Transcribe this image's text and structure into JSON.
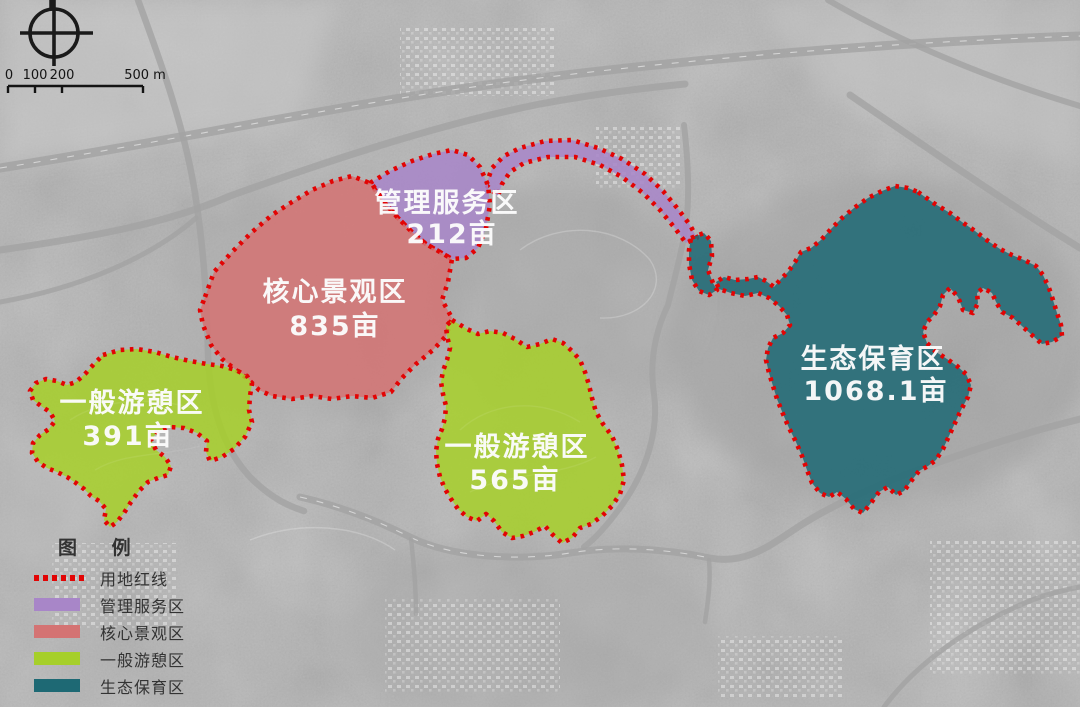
{
  "map": {
    "title_note": "park functional zoning over grayscale satellite imagery",
    "boundary_line_color": "#e20404",
    "zones": [
      {
        "name": "管理服务区",
        "area": "212亩",
        "color": "#a886c8"
      },
      {
        "name": "核心景观区",
        "area": "835亩",
        "color": "#d47373"
      },
      {
        "name": "一般游憩区",
        "area": "391亩",
        "color": "#a6cf2a"
      },
      {
        "name": "一般游憩区",
        "area": "565亩",
        "color": "#a6cf2a"
      },
      {
        "name": "生态保育区",
        "area": "1068.1亩",
        "color": "#1e6974"
      }
    ]
  },
  "scale_bar": {
    "labels": [
      "0",
      "100",
      "200",
      "500 m"
    ]
  },
  "legend": {
    "title": "图 例",
    "items": [
      {
        "label": "用地红线",
        "type": "red-dotted-line",
        "color": "#e20404"
      },
      {
        "label": "管理服务区",
        "type": "fill",
        "color": "#a886c8"
      },
      {
        "label": "核心景观区",
        "type": "fill",
        "color": "#d47373"
      },
      {
        "label": "一般游憩区",
        "type": "fill",
        "color": "#a6cf2a"
      },
      {
        "label": "生态保育区",
        "type": "fill",
        "color": "#1e6974"
      }
    ]
  }
}
